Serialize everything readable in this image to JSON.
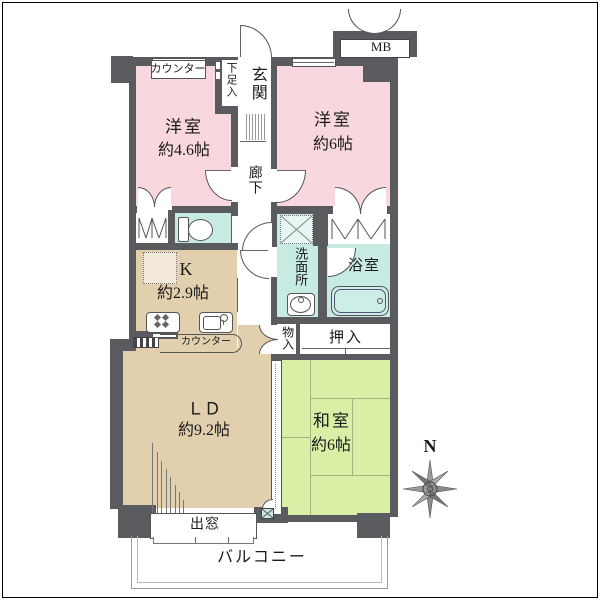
{
  "rooms": {
    "west_room_small": {
      "label": "洋室",
      "size": "約4.6帖"
    },
    "west_room_large": {
      "label": "洋室",
      "size": "約6帖"
    },
    "kitchen": {
      "label": "K",
      "size": "約2.9帖"
    },
    "living_dining": {
      "label": "ＬＤ",
      "size": "約9.2帖"
    },
    "japanese_room": {
      "label": "和室",
      "size": "約6帖"
    },
    "bathroom": {
      "label": "浴室"
    },
    "washroom": {
      "label": "洗面所"
    },
    "hallway": {
      "label": "廊下"
    },
    "entrance": {
      "label": "玄関"
    }
  },
  "features": {
    "counter_top": "カウンター",
    "kitchen_counter": "カウンター",
    "shoe_cabinet": "下足入",
    "meter_box": "MB",
    "storage_small": "物入",
    "futon_closet": "押入",
    "bay_window": "出窓",
    "balcony": "バルコニー",
    "compass_north": "N"
  },
  "colors": {
    "wall": "#595b5e",
    "western_room": "#f8d8de",
    "wet_area": "#c7eae2",
    "tatami_room": "#d9efa6",
    "kitchen_living": "#e2cfad"
  }
}
